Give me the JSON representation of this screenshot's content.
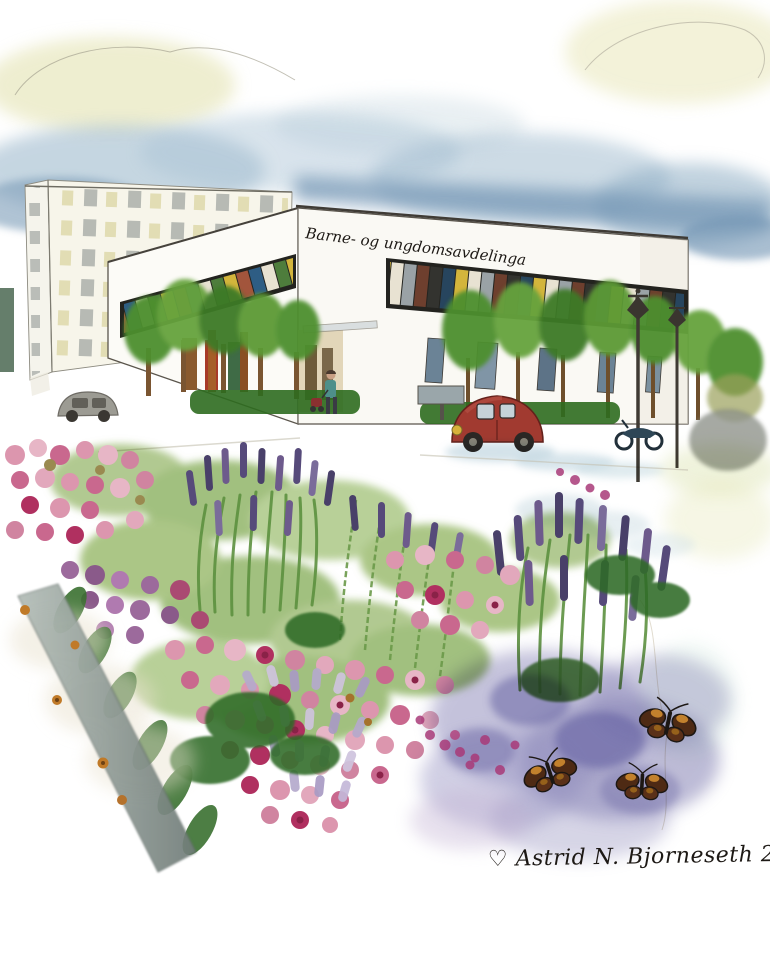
{
  "artwork": {
    "building_sign": "Barne- og ungdomsavdelinga",
    "signature": "♡ Astrid N. Bjorneseth  2015"
  },
  "palette": {
    "sky_blue": "#8fafc6",
    "deep_sky_blue": "#6f93b2",
    "cloud_yellow": "#e0dda6",
    "building_white": "#fbfaf5",
    "roof_ink": "#3f3b35",
    "tree_green": "#4e8f2e",
    "hedge_green": "#2e6b1f",
    "trunk_brown": "#7a5531",
    "car_red": "#a13a30",
    "flower_pink": "#d084a0",
    "flower_magenta": "#a83a78",
    "lavender_purple": "#564a7a",
    "bud_lilac": "#b5aacc",
    "wash_violet": "#8a86b8",
    "curb_gray": "#707c78",
    "butterfly_brown": "#4e2a14",
    "butterfly_orange": "#c8862e",
    "signature_ink": "#1d1915"
  }
}
